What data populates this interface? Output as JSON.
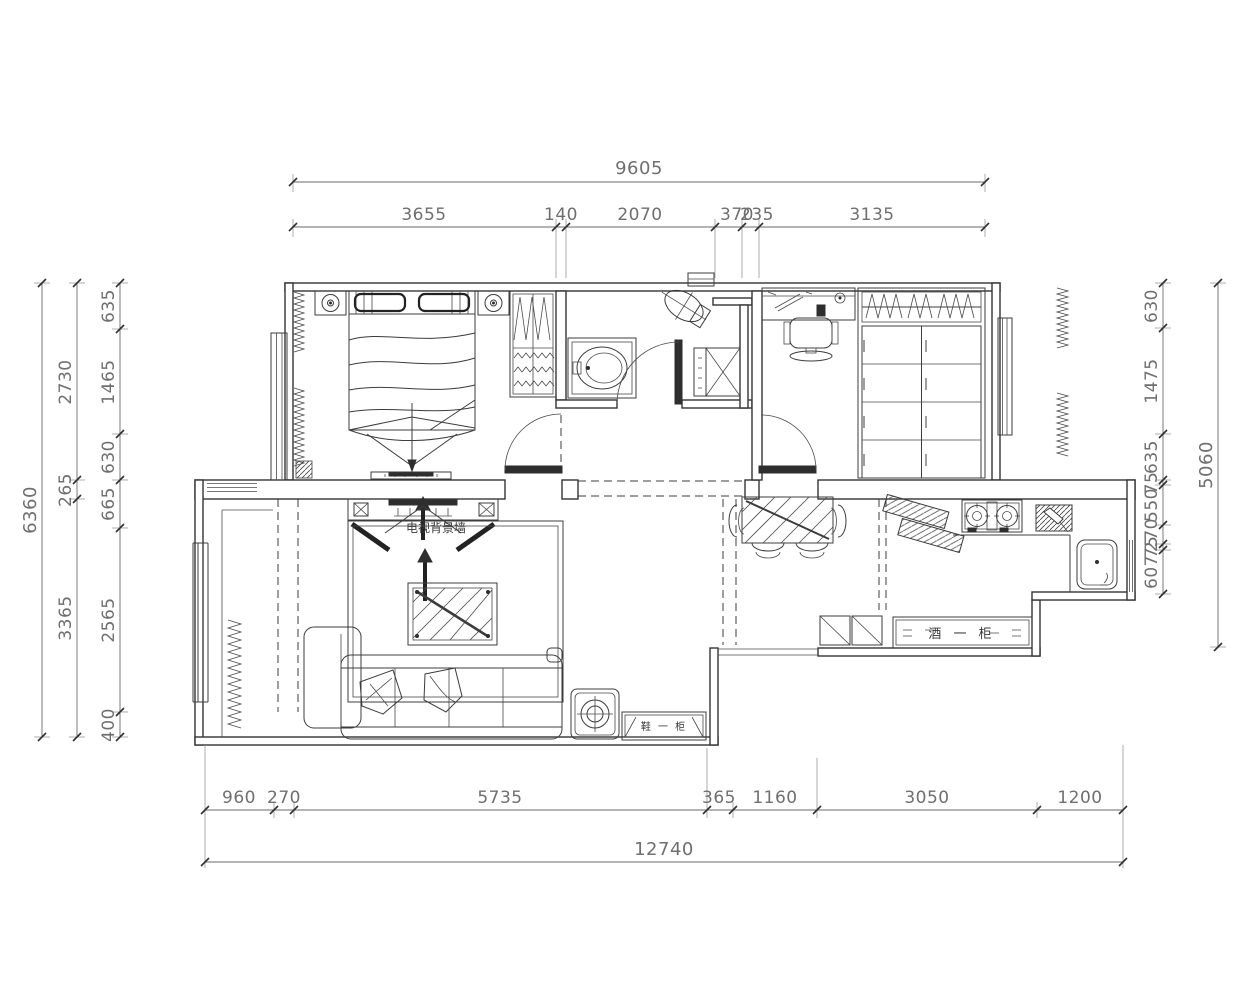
{
  "colors": {
    "line": "#343434",
    "dim_line": "#6a6a6a",
    "dim_text": "#6f6f6f",
    "background": "#ffffff"
  },
  "dimensions": {
    "top": {
      "total": "9605",
      "segments": [
        "3655",
        "140",
        "2070",
        "370",
        "235",
        "3135"
      ]
    },
    "left": {
      "total": "6360",
      "mid": [
        "2730",
        "265",
        "3365"
      ],
      "inner": [
        "635",
        "1465",
        "630",
        "665",
        "2565",
        "400"
      ]
    },
    "right": {
      "total": "5060",
      "inner": [
        "630",
        "1475",
        "635",
        "75",
        "550",
        "270",
        "75",
        "607"
      ]
    },
    "bottom": {
      "total": "12740",
      "segments": [
        "960",
        "270",
        "5735",
        "365",
        "1160",
        "3050",
        "1200"
      ]
    }
  },
  "annotations": {
    "tv_wall": "电视背景墙",
    "wine_cabinet": "酒 一 柜",
    "shoe_cabinet": "鞋 一 柜"
  }
}
